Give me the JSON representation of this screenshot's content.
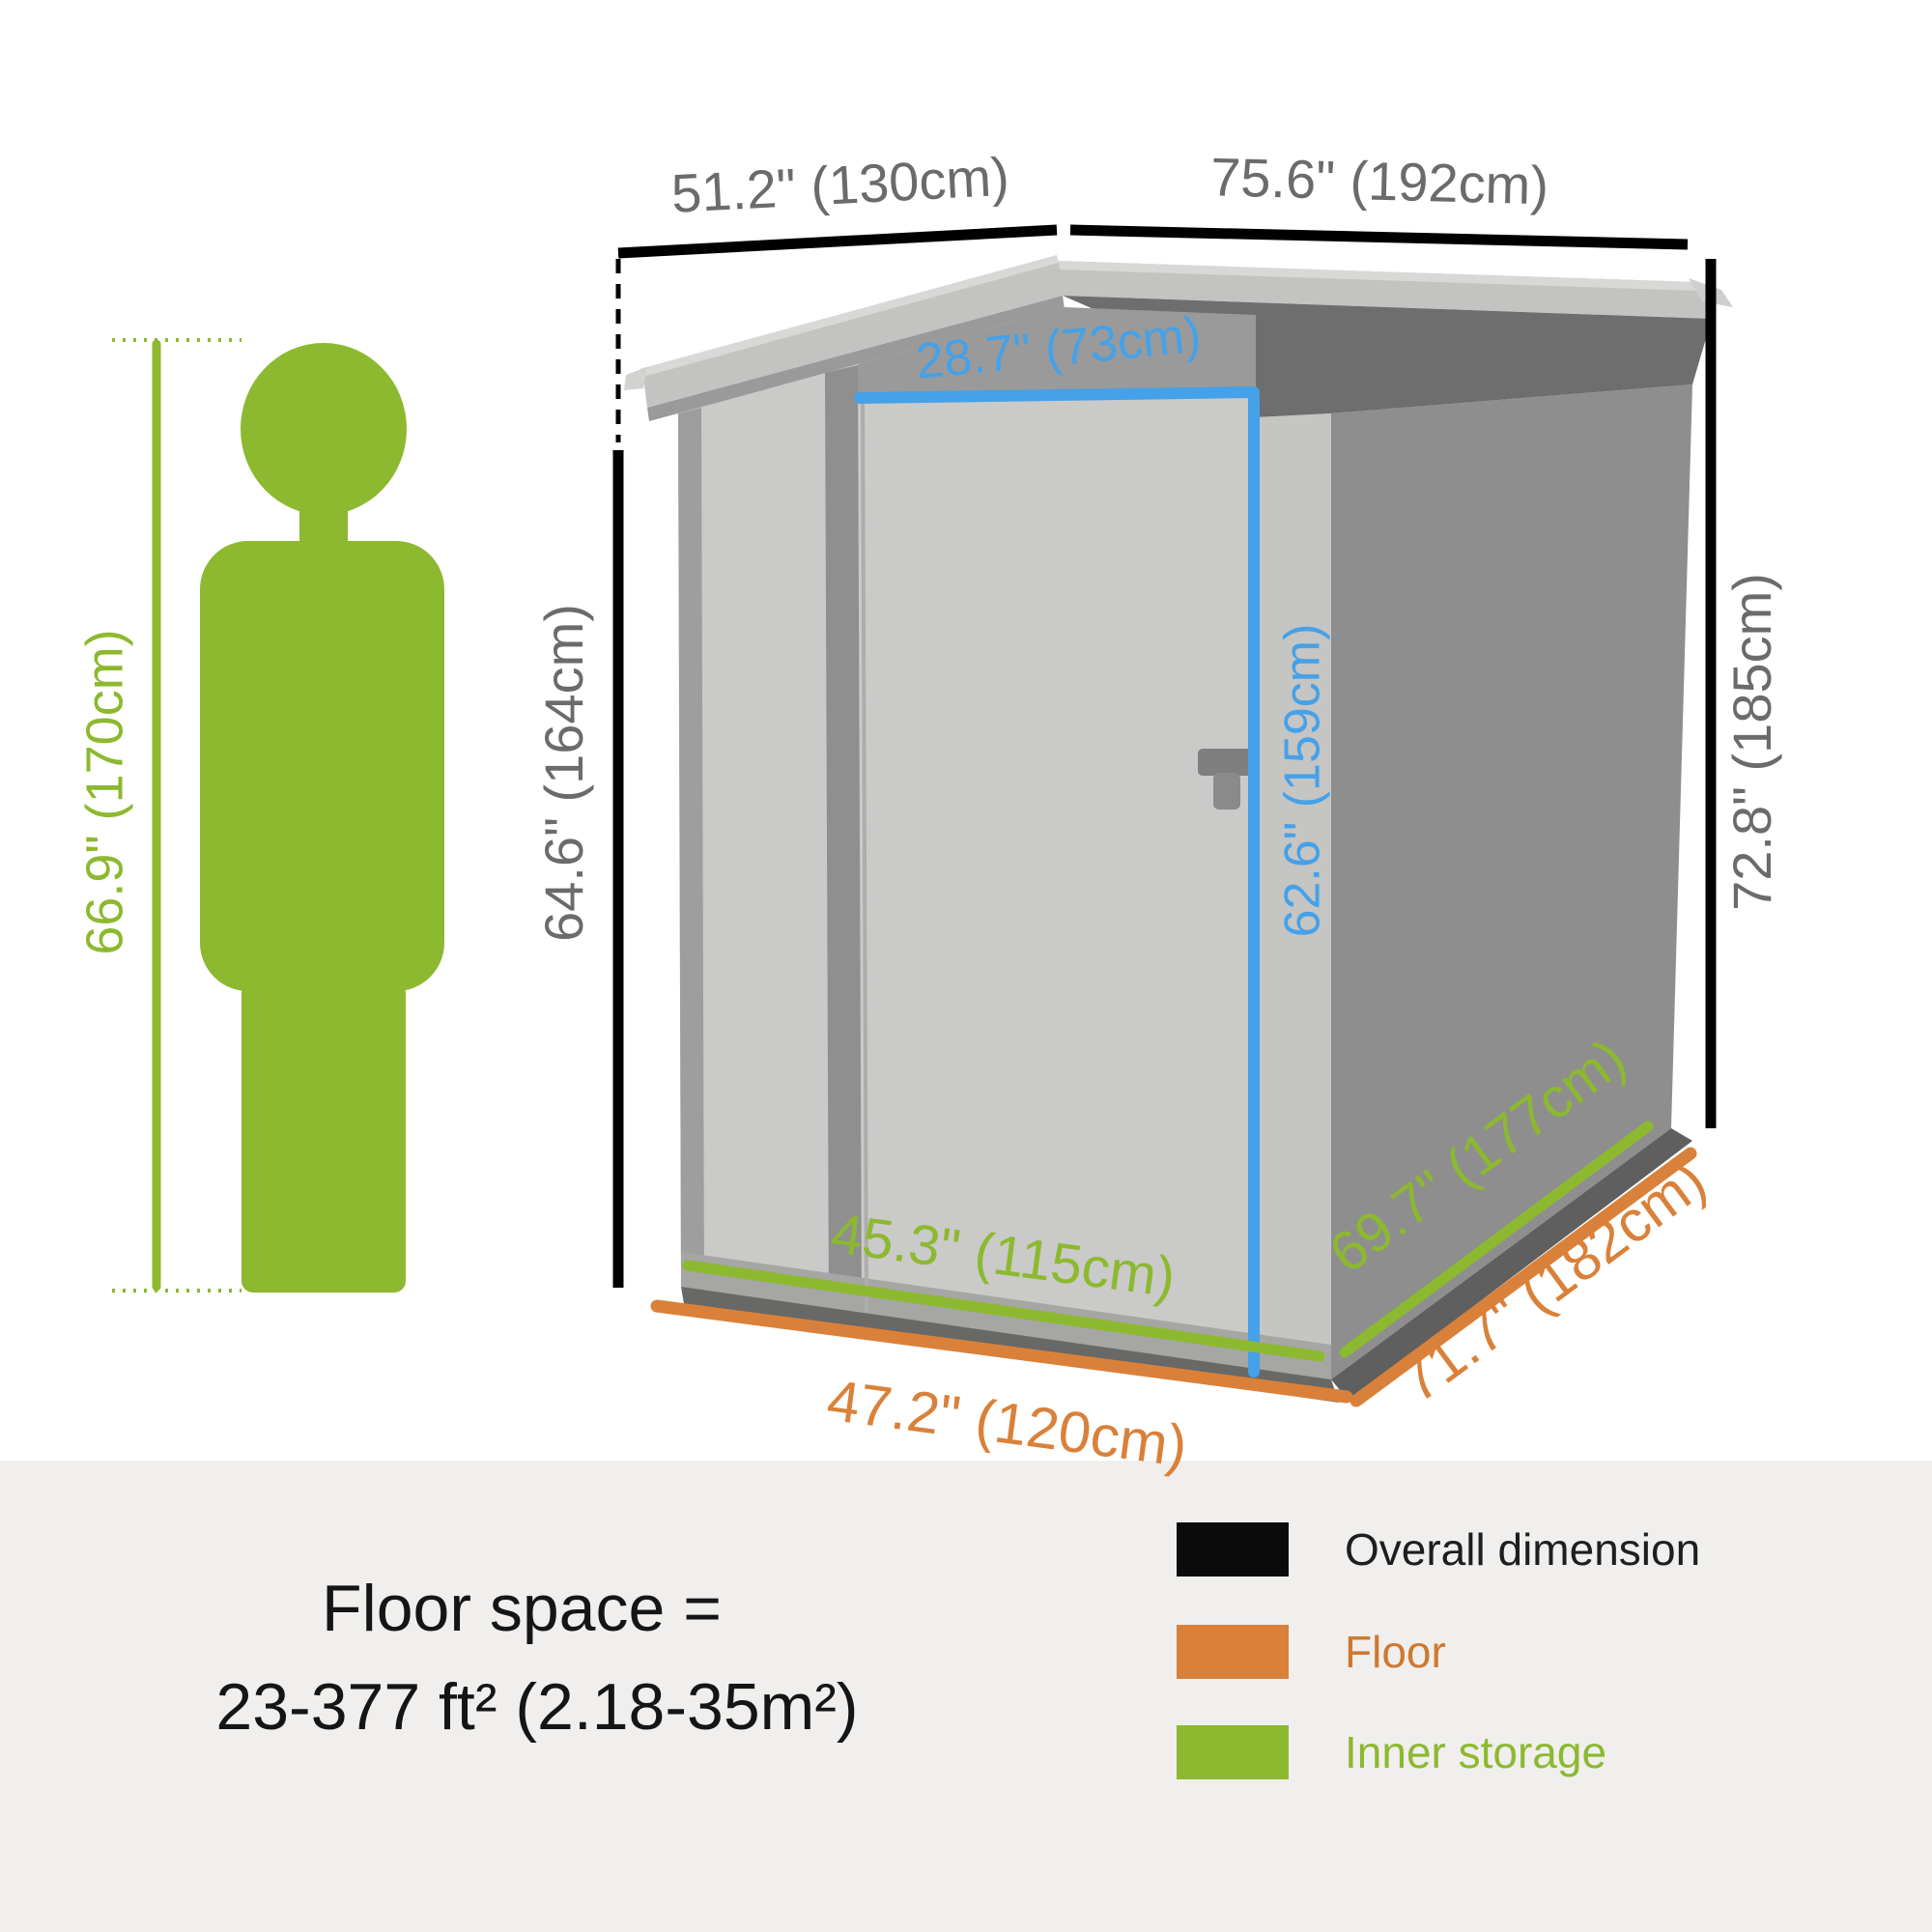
{
  "diagram": {
    "person": {
      "height_label": "66.9\" (170cm)"
    },
    "overall": {
      "width_label": "51.2\" (130cm)",
      "depth_label": "75.6\" (192cm)",
      "left_height_label": "64.6\" (164cm)",
      "right_height_label": "72.8\" (185cm)"
    },
    "door": {
      "width_label": "28.7\" (73cm)",
      "height_label": "62.6\" (159cm)"
    },
    "inner": {
      "front_label": "45.3\" (115cm)",
      "side_label": "69.7\" (177cm)"
    },
    "floor": {
      "front_label": "47.2\" (120cm)",
      "side_label": "71.7\" (182cm)"
    }
  },
  "footer": {
    "floor_space_line1": "Floor space =",
    "floor_space_line2": "23-377 ft² (2.18-35m²)",
    "legend": [
      {
        "label": "Overall dimension",
        "color": "#0b0b0b"
      },
      {
        "label": "Floor",
        "color": "#d9813a"
      },
      {
        "label": "Inner storage",
        "color": "#8cb92f"
      }
    ]
  },
  "colors": {
    "overall_dimension": "#000000",
    "floor": "#d9813a",
    "inner_storage": "#8cb92f",
    "door_dimension": "#45a1e8",
    "dim_text_gray": "#6b6b6b",
    "footer_background": "#f0efed"
  }
}
